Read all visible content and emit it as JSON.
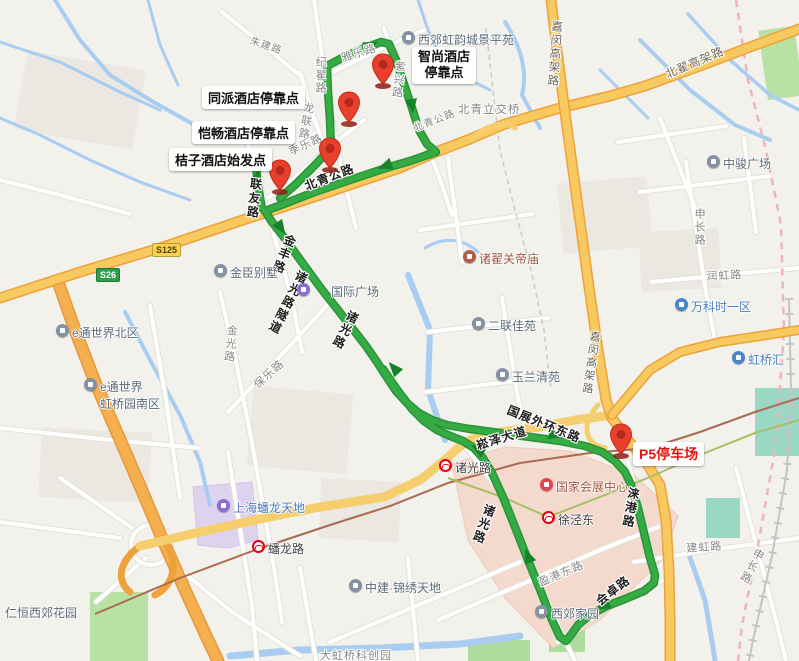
{
  "stops": {
    "zhishang_line1": "智尚酒店",
    "zhishang_line2": "停靠点",
    "tongpai": "同派酒店停靠点",
    "kaichang": "恺畅酒店停靠点",
    "juzi": "桔子酒店始发点",
    "p5": "P5停车场"
  },
  "roads": {
    "zhujian": "朱建路",
    "yayue": "雅乐路",
    "jizhai": "纪翟路",
    "zixing": "紫兴路",
    "longlian": "龙联路",
    "jile": "季乐路",
    "lianyou": "联友路",
    "beiqing_on_route": "北青公路",
    "beiqing_gray": "北青公路",
    "beiqing_interchange": "北青立交桥",
    "jiamin_north": "嘉闵高架路",
    "jiamin_south": "嘉闵高架路",
    "beidi": "北翟高架路",
    "jinfeng": "金丰路",
    "zhuguang_tunnel": "诸光路隧道",
    "zhuguang_mid": "诸光路",
    "zhuguang_south": "诸光路",
    "jinguang": "金光路",
    "baole": "保乐路",
    "songze_dadao": "崧泽大道",
    "guozhan_waihuan": "国展外环东路",
    "laigang": "涞港路",
    "huizhuo": "会卓路",
    "yinggang": "盈港东路",
    "jianhong": "建虹路",
    "shenchang_north": "申长路",
    "shenchang_south": "申长路",
    "runhong": "润虹路",
    "dahongqiao": "大虹桥科创园"
  },
  "pois": {
    "xijiao_hongyun": "西郊虹韵城景平苑",
    "zhongjun": "中骏广场",
    "wanke": "万科时一区",
    "hongqiaohui": "虹桥汇",
    "guandimiao": "诸翟关帝庙",
    "erlian": "二联佳苑",
    "yulan": "玉兰清苑",
    "jinchen": "金臣别墅",
    "guoji_guangchang": "国际广场",
    "etong_north": "e通世界北区",
    "etong_south_l1": "e通世界",
    "etong_south_l2": "虹桥园南区",
    "renheng": "仁恒西郊花园",
    "panlong_tiandi": "上海蟠龙天地",
    "zhongjian": "中建·锦绣天地",
    "xijiao_jiayuan": "西郊家园",
    "necc": "国家会展中心"
  },
  "metro": {
    "xujingdong": "徐泾东",
    "zhuguang_station": "诸光路",
    "panlong_station": "蟠龙路"
  },
  "badges": {
    "s125": "S125",
    "s26": "S26"
  },
  "colors": {
    "route_green": "#35ab44",
    "arrow_green": "#17822c",
    "highway_fill": "#f8c95f",
    "highway_casing": "#eda23b",
    "water": "#a9cdf1",
    "necc_fill": "#f4d9cd",
    "tiandi_fill": "#ddd3ef",
    "park": "#b8e2a4",
    "park_teal": "#9ad7c5",
    "pin_red": "#e8402d",
    "boundary_pink": "#efb3c0"
  }
}
